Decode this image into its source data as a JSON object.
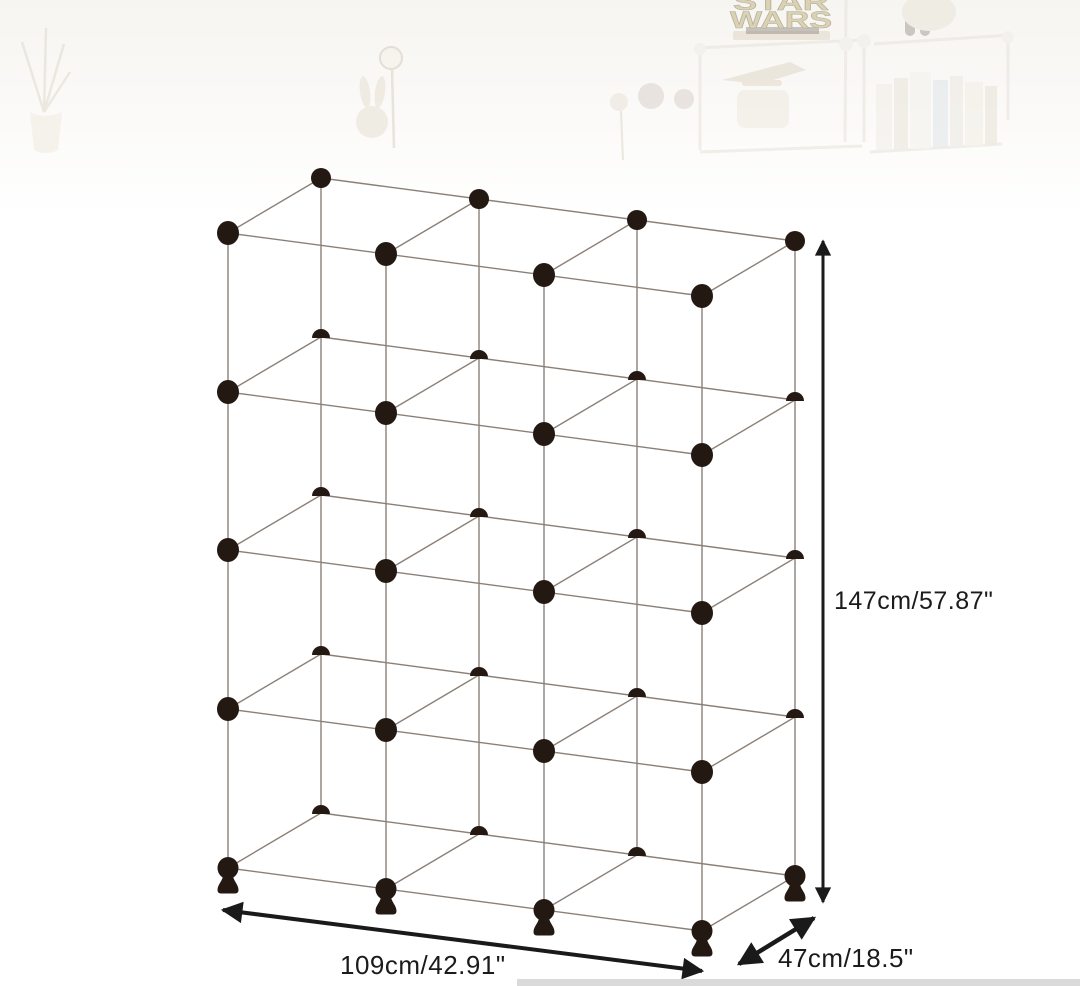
{
  "canvas": {
    "width": 1080,
    "height": 986,
    "background": "#ffffff"
  },
  "diagram": {
    "product": "cube-storage-organizer-wireframe",
    "grid": {
      "columns": 3,
      "rows": 4,
      "depth_cubes": 1,
      "total_cubes": 12
    },
    "dimensions": {
      "height_label": "147cm/57.87\"",
      "width_label": "109cm/42.91\"",
      "depth_label": "47cm/18.5\""
    },
    "colors": {
      "connector": "#241812",
      "frame_line": "#8b8078",
      "annotation": "#1a1a1a",
      "edge_strip": "#dadada"
    }
  },
  "background_photo": {
    "sign_line1": "STAR",
    "sign_line2": "WARS"
  },
  "wireframe_geometry": {
    "x0": 228,
    "col_step": 158,
    "posts": 4,
    "levels": [
      233,
      392,
      550,
      709,
      868
    ],
    "col_rise": 21,
    "depth_dx": 93,
    "depth_dy": -55,
    "front_dot_rx": 11,
    "front_dot_ry": 12,
    "back_dot_r": 10,
    "half_dot_r": 9
  }
}
